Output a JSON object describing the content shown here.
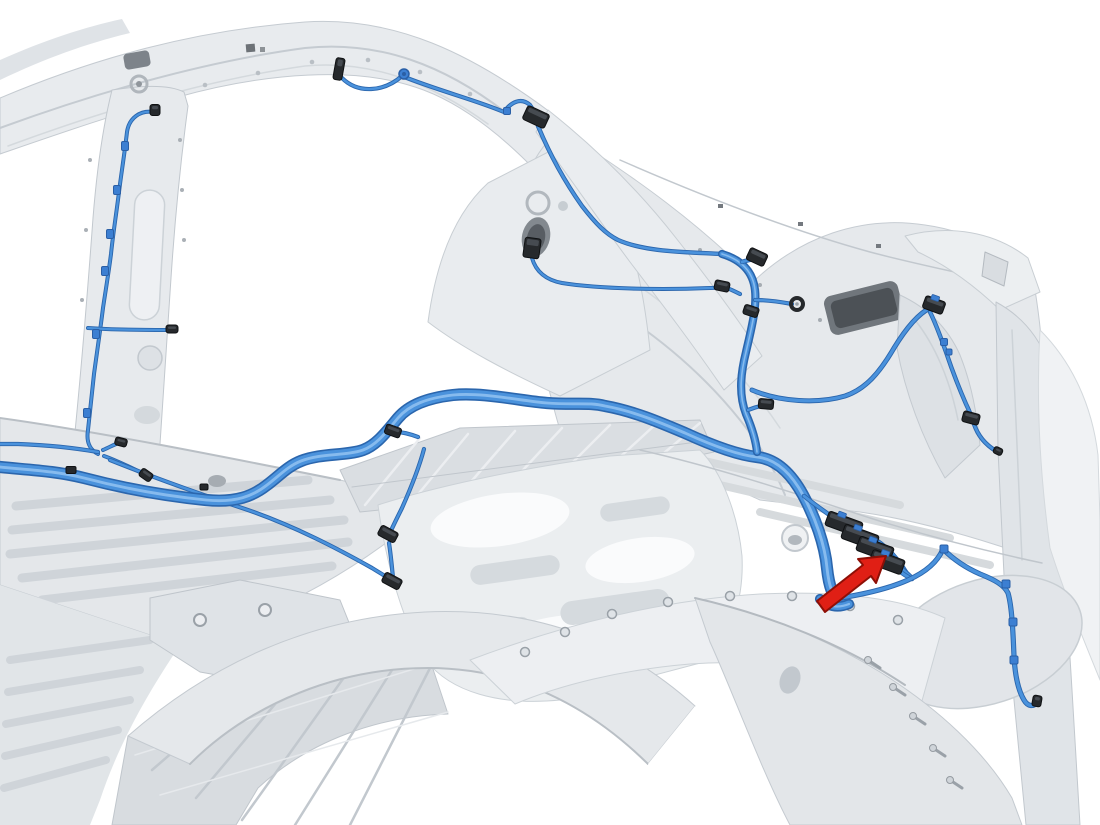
{
  "canvas": {
    "viewBox": "0 0 1100 825",
    "width": 1100,
    "height": 825
  },
  "colors": {
    "background": "#ffffff",
    "panel": "#e7eaed",
    "panel_light": "#f1f3f5",
    "panel_mid": "#d4d9dd",
    "panel_dark": "#b9bfc5",
    "line_dark": "#9aa1a8",
    "hole_dark": "#74797f",
    "harness_outline": "#2b66ad",
    "harness_core": "#4a92dc",
    "harness_highlight": "#8ec0f0",
    "connector_body": "#26292c",
    "connector_edge": "#0f1113",
    "connector_face": "#4a4f55",
    "clip_blue": "#3c7fd2",
    "clip_blue_dark": "#2a5fa6",
    "arrow_fill": "#e01f15",
    "arrow_stroke": "#8e0f06"
  },
  "harness": {
    "segments": [
      {
        "name": "roof-rail-wire",
        "w": 2.4,
        "d": "M342,78 C358,94 384,92 402,76 C436,90 476,100 504,112 C511,102 521,97 530,105 L536,114"
      },
      {
        "name": "c-pillar-wire",
        "w": 2.6,
        "d": "M538,126 C550,155 565,182 582,206 C596,224 606,234 618,240 C645,252 685,252 722,254"
      },
      {
        "name": "c-pillar-mid-pigtail",
        "w": 2.2,
        "d": "M532,258 C536,272 546,280 562,283 C600,289 660,290 710,288 C716,288 720,287 722,286"
      },
      {
        "name": "b-pillar-wire",
        "w": 2.2,
        "d": "M154,112 C140,110 129,118 127,132 C124,158 121,175 119,192 C116,216 113,234 111,254 C109,270 106,288 103,308 C100,332 97,352 94,374 C92,394 90,412 88,430 C86,442 90,450 98,454"
      },
      {
        "name": "rocker-wire",
        "w": 2.4,
        "d": "M98,452 C75,448 45,445 18,444 L0,444"
      },
      {
        "name": "pillar-base-stub-a",
        "w": 2.2,
        "d": "M103,450 C110,447 115,444 119,443"
      },
      {
        "name": "pillar-base-stub-b",
        "w": 2.2,
        "d": "M104,456 C118,461 132,468 144,474"
      },
      {
        "name": "pillar-base-long-branch",
        "w": 2.4,
        "d": "M110,460 C150,476 200,494 245,509 C295,526 340,550 372,568 C380,573 387,577 391,580"
      },
      {
        "name": "pillar-mid-stub",
        "w": 2.2,
        "d": "M88,328 C115,330 142,330 166,330"
      },
      {
        "name": "main-floor-harness",
        "w": 9,
        "d": "M0,467 C30,470 56,471 84,478 C126,489 166,496 206,500 C236,503 253,496 267,485 C279,476 288,466 301,461 C321,453 346,456 363,450 C377,445 387,431 398,418 C409,405 427,398 453,395 C483,392 521,401 547,403 C575,405 589,402 605,406 C633,411 659,422 685,433 C709,444 737,455 757,457 C776,459 791,473 803,495 C815,517 825,545 827,568 C829,587 833,598 841,603"
      },
      {
        "name": "harness-foot",
        "w": 7,
        "d": "M820,599 C827,606 837,609 849,604"
      },
      {
        "name": "quarter-bundle",
        "w": 5,
        "d": "M722,254 C742,260 753,272 755,290 C757,308 751,330 746,352 C740,376 739,396 746,414 C752,428 756,442 757,452"
      },
      {
        "name": "bundle-stub-top",
        "w": 2.8,
        "d": "M742,262 C748,260 753,259 757,258"
      },
      {
        "name": "bundle-stub-left",
        "w": 2.4,
        "d": "M740,294 C734,291 728,288 724,287"
      },
      {
        "name": "bundle-stub-eyelet",
        "w": 2.4,
        "d": "M755,300 C768,300 781,302 792,304"
      },
      {
        "name": "bundle-stub-low",
        "w": 2.4,
        "d": "M748,410 C753,408 760,406 765,405"
      },
      {
        "name": "quarter-right-branch",
        "w": 3.2,
        "d": "M752,390 C780,402 818,404 845,396 C866,389 880,372 894,348 C905,330 918,314 930,308"
      },
      {
        "name": "taillight-wire",
        "w": 2.6,
        "d": "M930,312 C936,324 941,338 946,352 C952,370 959,388 966,404 C970,412 972,418 974,424 C978,436 986,445 996,451"
      },
      {
        "name": "floor-branch-stub",
        "w": 2.4,
        "d": "M418,437 C410,434 403,432 396,432"
      },
      {
        "name": "floor-branch-mid",
        "w": 2.4,
        "d": "M424,449 C419,468 410,490 402,508 C396,520 392,528 390,533"
      },
      {
        "name": "floor-branch-low",
        "w": 2.4,
        "d": "M389,543 C391,556 392,568 393,578"
      },
      {
        "name": "cluster-pigtail-1",
        "w": 2.8,
        "d": "M804,496 C818,507 832,517 842,523"
      },
      {
        "name": "cluster-pigtail-2",
        "w": 2.8,
        "d": "M859,531 C880,539 897,556 907,574"
      },
      {
        "name": "cluster-pigtail-3",
        "w": 2.8,
        "d": "M876,545 C890,553 901,564 908,575"
      },
      {
        "name": "cluster-pigtail-4",
        "w": 2.8,
        "d": "M889,558 C897,565 905,571 911,577"
      },
      {
        "name": "cluster-pigtail-5",
        "w": 2.8,
        "d": "M898,570 C903,574 908,577 912,579"
      },
      {
        "name": "rear-continuation-wire",
        "w": 3.4,
        "d": "M840,598 C865,594 890,588 908,580 C926,572 938,561 943,549 C951,557 964,567 980,574 C995,580 1004,585 1008,593 C1012,607 1013,632 1014,656 C1015,676 1018,690 1024,700 C1028,707 1034,707 1037,702"
      }
    ]
  },
  "connectors": [
    {
      "name": "roof-rail-clip-connector",
      "cx": 339,
      "cy": 69,
      "w": 9,
      "h": 22,
      "angle": 10
    },
    {
      "name": "c-pillar-upper-connector",
      "cx": 536,
      "cy": 117,
      "w": 24,
      "h": 15,
      "angle": 25
    },
    {
      "name": "c-pillar-mid-connector",
      "cx": 532,
      "cy": 248,
      "w": 16,
      "h": 20,
      "angle": 8
    },
    {
      "name": "b-pillar-top-clip",
      "cx": 155,
      "cy": 110,
      "w": 10,
      "h": 11,
      "angle": 0
    },
    {
      "name": "pillar-mid-end-clip",
      "cx": 172,
      "cy": 329,
      "w": 12,
      "h": 8,
      "angle": 0
    },
    {
      "name": "quarter-top-connector",
      "cx": 757,
      "cy": 257,
      "w": 19,
      "h": 13,
      "angle": 25
    },
    {
      "name": "quarter-left-connector",
      "cx": 722,
      "cy": 286,
      "w": 15,
      "h": 10,
      "angle": 12
    },
    {
      "name": "quarter-mid-connector",
      "cx": 751,
      "cy": 311,
      "w": 15,
      "h": 10,
      "angle": 18
    },
    {
      "name": "quarter-low-connector",
      "cx": 766,
      "cy": 404,
      "w": 15,
      "h": 10,
      "angle": 5
    },
    {
      "name": "branch-end-connector",
      "cx": 934,
      "cy": 305,
      "w": 21,
      "h": 13,
      "angle": 20,
      "tab": true
    },
    {
      "name": "taillight-low-connector",
      "cx": 971,
      "cy": 418,
      "w": 17,
      "h": 11,
      "angle": 15
    },
    {
      "name": "taillight-end-cap",
      "cx": 998,
      "cy": 451,
      "w": 9,
      "h": 7,
      "angle": 25
    },
    {
      "name": "cluster-connector-1",
      "cx": 844,
      "cy": 524,
      "w": 36,
      "h": 15,
      "angle": 20,
      "tab": true
    },
    {
      "name": "cluster-connector-2",
      "cx": 860,
      "cy": 537,
      "w": 36,
      "h": 15,
      "angle": 20,
      "tab": true
    },
    {
      "name": "cluster-connector-3",
      "cx": 875,
      "cy": 549,
      "w": 36,
      "h": 15,
      "angle": 20,
      "tab": true
    },
    {
      "name": "cluster-connector-4",
      "cx": 887,
      "cy": 562,
      "w": 34,
      "h": 15,
      "angle": 20,
      "tab": true
    },
    {
      "name": "floor-branch-connector-a",
      "cx": 393,
      "cy": 431,
      "w": 16,
      "h": 10,
      "angle": 20
    },
    {
      "name": "floor-branch-connector-b",
      "cx": 388,
      "cy": 534,
      "w": 19,
      "h": 11,
      "angle": 28
    },
    {
      "name": "floor-branch-connector-c",
      "cx": 392,
      "cy": 581,
      "w": 19,
      "h": 11,
      "angle": 28
    },
    {
      "name": "pillar-base-connector-a",
      "cx": 121,
      "cy": 442,
      "w": 12,
      "h": 8,
      "angle": 15
    },
    {
      "name": "pillar-base-connector-b",
      "cx": 146,
      "cy": 475,
      "w": 13,
      "h": 9,
      "angle": 35
    },
    {
      "name": "rear-end-connector",
      "cx": 1037,
      "cy": 701,
      "w": 9,
      "h": 11,
      "angle": 10
    }
  ],
  "clips": [
    {
      "x": 125,
      "y": 146,
      "w": 7,
      "h": 9,
      "color": "blue"
    },
    {
      "x": 117,
      "y": 190,
      "w": 7,
      "h": 9,
      "color": "blue"
    },
    {
      "x": 110,
      "y": 234,
      "w": 7,
      "h": 9,
      "color": "blue"
    },
    {
      "x": 105,
      "y": 271,
      "w": 7,
      "h": 9,
      "color": "blue"
    },
    {
      "x": 96,
      "y": 334,
      "w": 7,
      "h": 9,
      "color": "blue"
    },
    {
      "x": 87,
      "y": 413,
      "w": 7,
      "h": 9,
      "color": "blue"
    },
    {
      "x": 507,
      "y": 111,
      "w": 7,
      "h": 7,
      "color": "blue"
    },
    {
      "x": 944,
      "y": 342,
      "w": 7,
      "h": 7,
      "color": "blue"
    },
    {
      "x": 949,
      "y": 352,
      "w": 6,
      "h": 6,
      "color": "blue"
    },
    {
      "x": 944,
      "y": 549,
      "w": 8,
      "h": 8,
      "color": "blue"
    },
    {
      "x": 1006,
      "y": 584,
      "w": 8,
      "h": 8,
      "color": "blue"
    },
    {
      "x": 1013,
      "y": 622,
      "w": 8,
      "h": 8,
      "color": "blue"
    },
    {
      "x": 1014,
      "y": 660,
      "w": 8,
      "h": 8,
      "color": "blue"
    },
    {
      "x": 71,
      "y": 470,
      "w": 10,
      "h": 7,
      "color": "black"
    },
    {
      "x": 204,
      "y": 487,
      "w": 8,
      "h": 6,
      "color": "black"
    }
  ],
  "grommets": [
    {
      "x": 404,
      "y": 74,
      "r": 5
    }
  ],
  "eyelets": [
    {
      "x": 797,
      "y": 304,
      "r": 6
    }
  ],
  "callout_arrow": {
    "points": "817,601 863,565 858,559 886,556 876,583 871,576 825,612"
  }
}
